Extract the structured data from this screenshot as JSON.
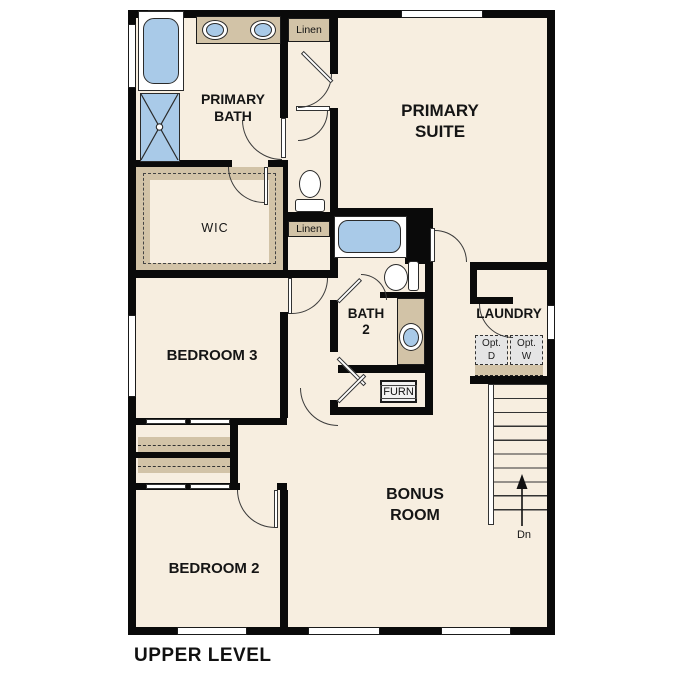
{
  "plan": {
    "title": "UPPER LEVEL",
    "rooms": {
      "primary_bath": "PRIMARY\nBATH",
      "primary_suite": "PRIMARY\nSUITE",
      "wic": "WIC",
      "bath2": "BATH\n2",
      "laundry": "LAUNDRY",
      "bedroom3": "BEDROOM 3",
      "bedroom2": "BEDROOM 2",
      "bonus_room": "BONUS\nROOM"
    },
    "closets": {
      "linen_top": "Linen",
      "linen_mid": "Linen",
      "furnace": "FURN"
    },
    "laundry_appliances": {
      "optional_dryer": "Opt.\nD",
      "optional_washer": "Opt.\nW"
    },
    "stairs": {
      "down_label": "Dn"
    },
    "colors": {
      "wall": "#0a0a0a",
      "room_fill": "#f7eee0",
      "cabinet_tan": "#d2c3a7",
      "fixture_blue": "#a9cae8",
      "appliance_gray": "#e5e5e5"
    }
  }
}
